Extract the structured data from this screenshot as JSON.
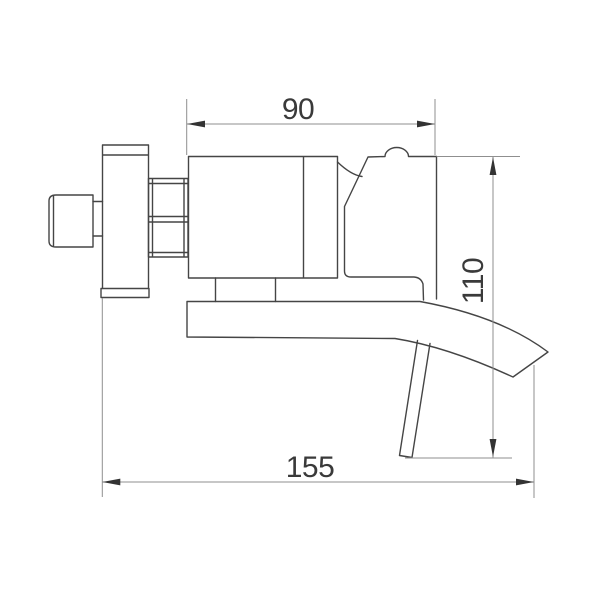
{
  "drawing": {
    "type": "technical-dimension-drawing",
    "subject": "wall-mounted waterfall bathtub faucet, side elevation",
    "dimensions": {
      "top_width": {
        "label": "90",
        "value": 90,
        "orientation": "horizontal"
      },
      "side_height": {
        "label": "110",
        "value": 110,
        "orientation": "vertical"
      },
      "overall_length": {
        "label": "155",
        "value": 155,
        "orientation": "horizontal"
      }
    }
  },
  "colors": {
    "background": "#ffffff",
    "outline": "#454545",
    "dimension_line": "#8f8f8f",
    "arrow": "#333333",
    "text": "#3a3a3a"
  }
}
